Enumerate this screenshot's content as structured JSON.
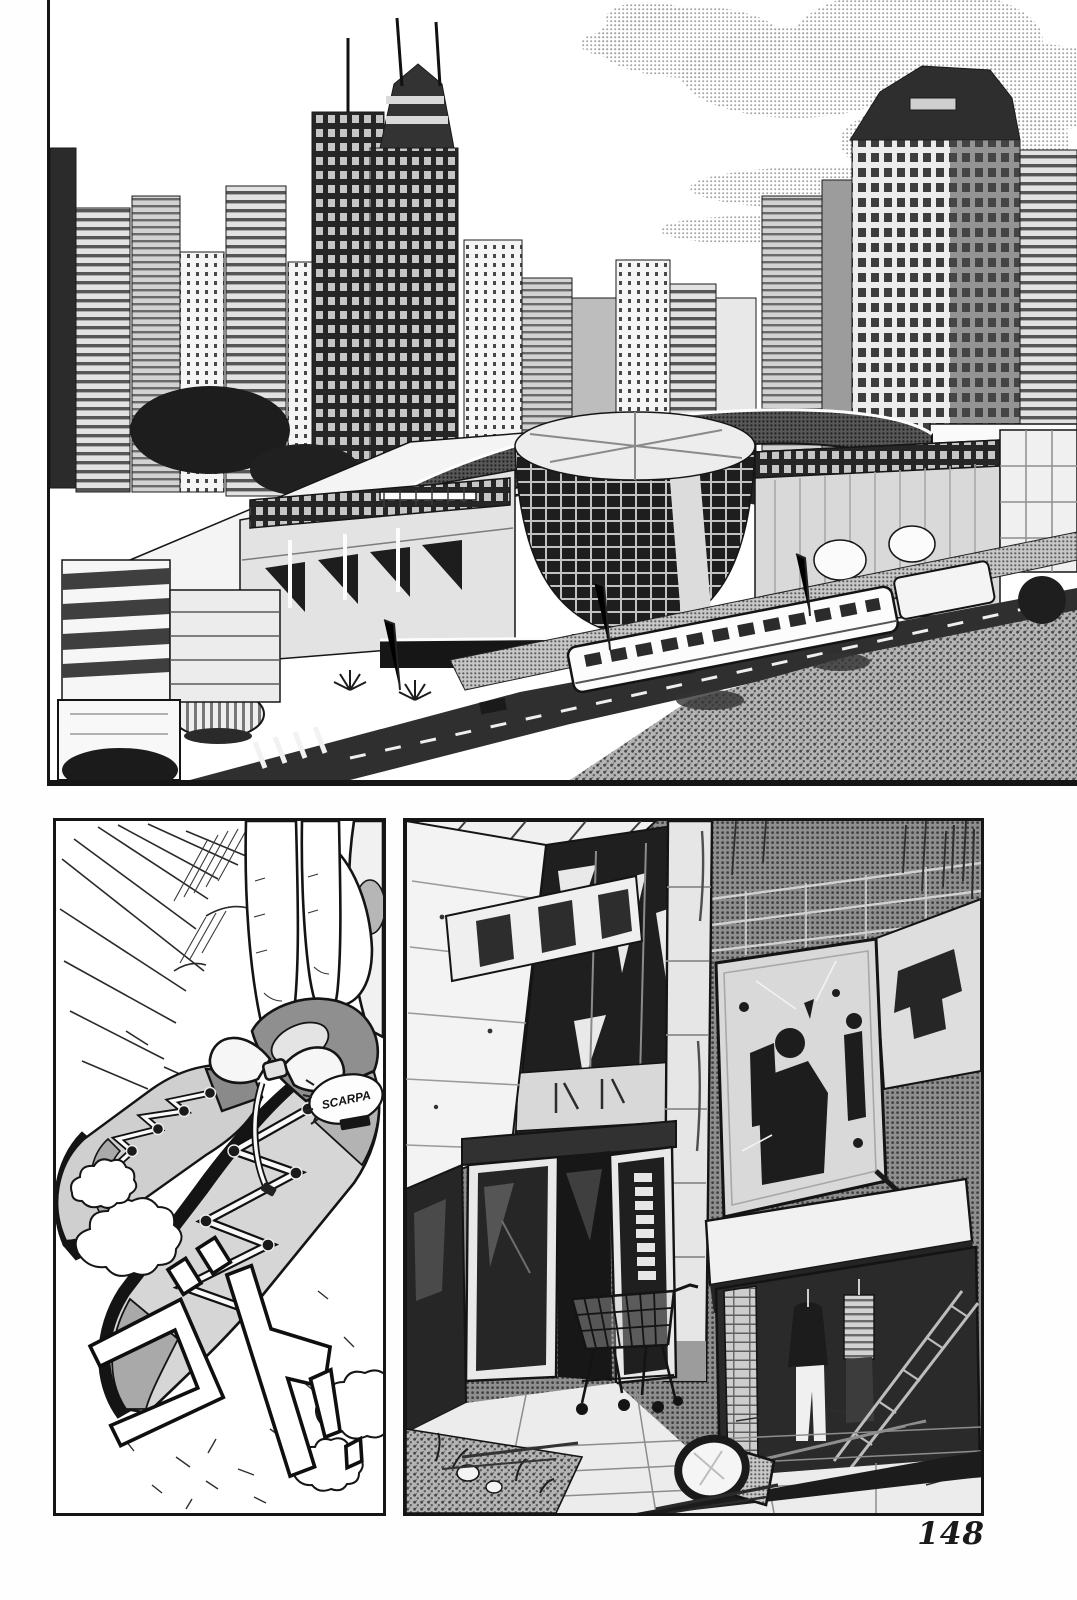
{
  "page": {
    "number": "148"
  },
  "sfx": {
    "impact": "ゴト",
    "exclaim": "!"
  },
  "boots": {
    "brand_patch": "SCARPA"
  },
  "colors": {
    "ink": "#141414",
    "paper": "#ffffff",
    "halftone_mid": "#9a9a9a",
    "halftone_dark": "#4c4c4c"
  }
}
